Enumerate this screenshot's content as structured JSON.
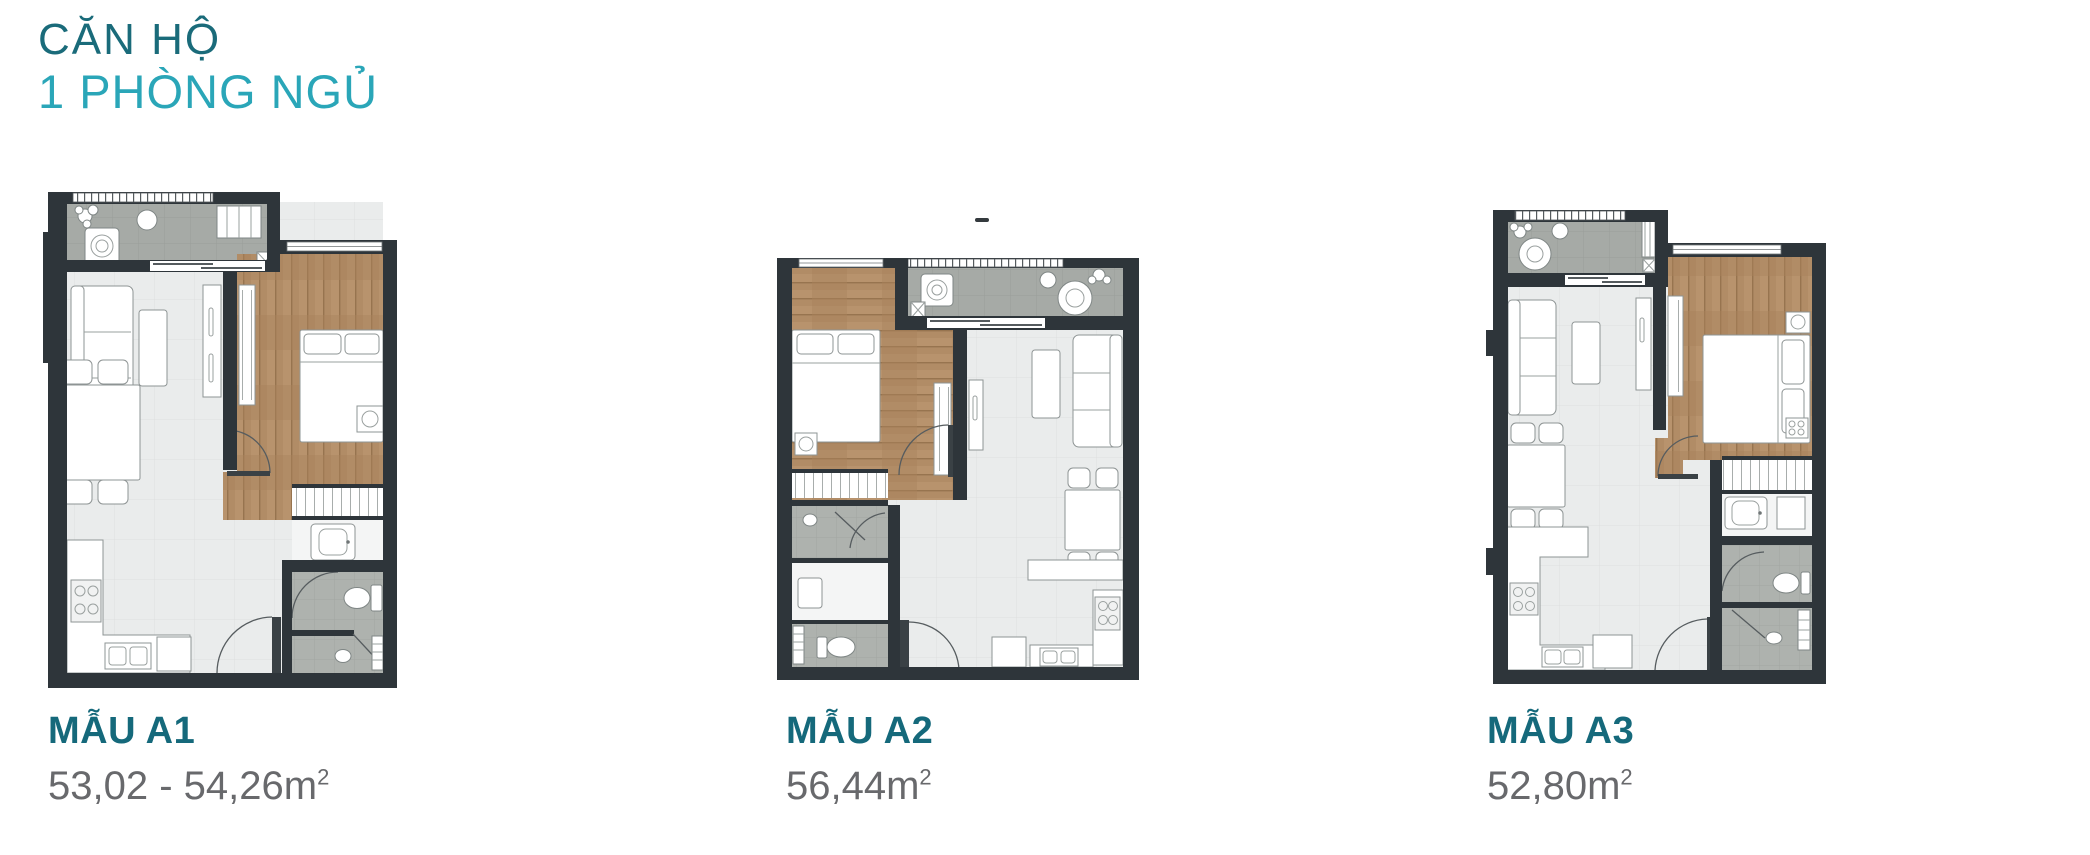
{
  "page": {
    "title_line1": "CĂN HỘ",
    "title_line2": "1 PHÒNG NGỦ"
  },
  "units": [
    {
      "id": "A1",
      "label": "MẪU A1",
      "area_value": "53,02 - 54,26m",
      "area_sup": "2"
    },
    {
      "id": "A2",
      "label": "MẪU A2",
      "area_value": "56,44m",
      "area_sup": "2"
    },
    {
      "id": "A3",
      "label": "MẪU A3",
      "area_value": "52,80m",
      "area_sup": "2"
    }
  ],
  "colors": {
    "title_primary": "#1a6b7a",
    "title_accent": "#2aa6b8",
    "unit_label_teal": "#15697b",
    "area_gray": "#68696c",
    "wall_dark": "#2e353a",
    "balcony_floor": "#a6aaa6",
    "wood_floor": "#b18c66",
    "living_floor": "#eaecec",
    "bath_floor": "#aeb2ae"
  }
}
